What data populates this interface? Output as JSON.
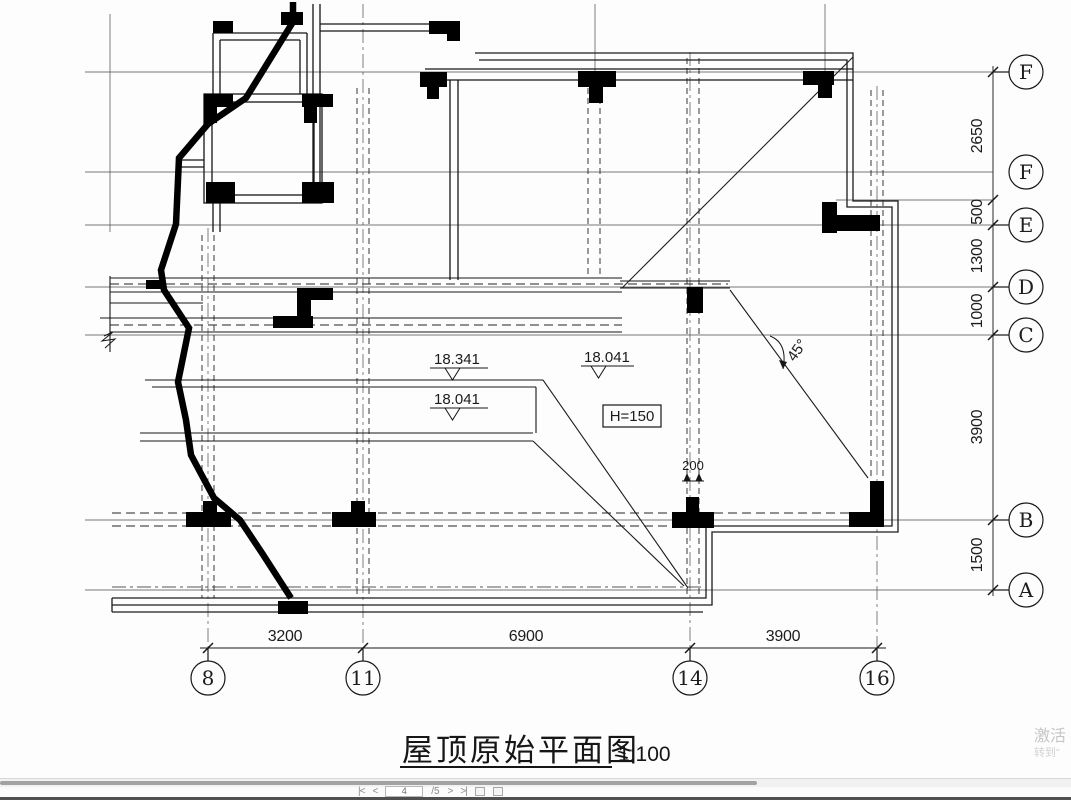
{
  "drawing": {
    "title": "屋顶原始平面图",
    "scale_label": "1:100",
    "row_bubbles": [
      "F",
      "F",
      "E",
      "D",
      "C",
      "B",
      "A"
    ],
    "col_bubbles": [
      "8",
      "11",
      "14",
      "16"
    ],
    "right_dims": [
      "2650",
      "500",
      "1300",
      "1000",
      "3900",
      "1500"
    ],
    "bottom_dims": [
      "3200",
      "6900",
      "3900"
    ],
    "annotations": {
      "elev_top": "18.341",
      "elev_right": "18.041",
      "elev_panel": "18.041",
      "height_box": "H=150",
      "angle": "45°",
      "gap": "200"
    }
  },
  "viewer": {
    "pager": {
      "first": "|<",
      "prev": "<",
      "page": "4",
      "of": "/5",
      "next": ">",
      "last": ">|"
    },
    "watermark": {
      "line1": "激活",
      "line2": "转到“"
    }
  }
}
